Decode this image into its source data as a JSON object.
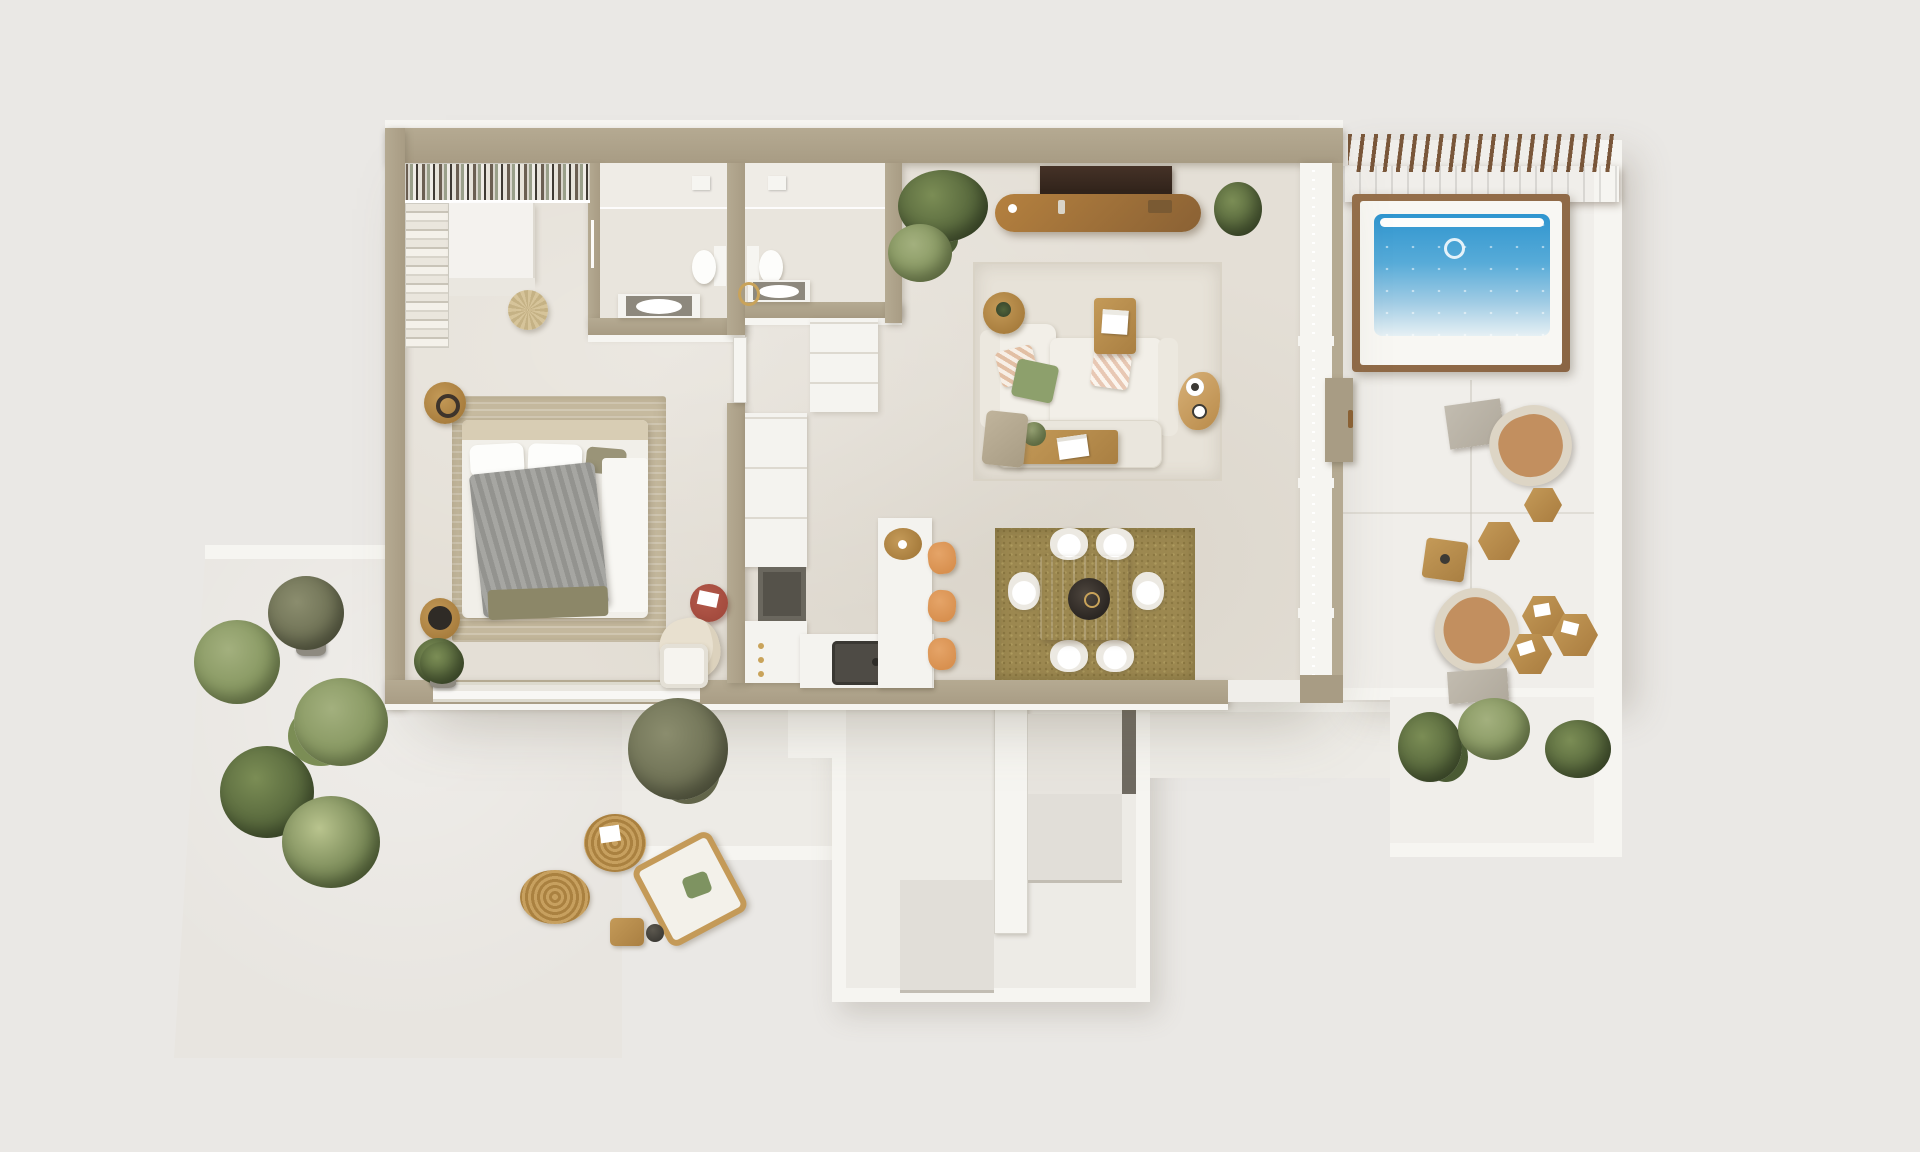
{
  "scene": {
    "view": "top-down 3D architectural floor plan render",
    "areas": [
      "walk-in-closet",
      "bedroom",
      "bathroom-1",
      "bathroom-2",
      "hallway",
      "kitchen",
      "dining-area",
      "living-room",
      "terrace-lounge",
      "pool-deck",
      "pergola",
      "patio-garden",
      "stairwell",
      "entry-landing"
    ]
  },
  "inventory": {
    "dining_chairs": 6,
    "bar_stools": 3,
    "sofas": 1,
    "beds": 1,
    "toilets": 2,
    "sinks": 3,
    "pools": 1,
    "lounge_chairs_terrace": 2,
    "lounge_chairs_patio": 2,
    "jute_rugs": 2,
    "plants": 14,
    "stair_flights": 2
  },
  "colors": {
    "bgPage": "#eae8e5",
    "wall": "#a89c84",
    "wallLight": "#b5aa92",
    "whiteW": "#f6f5f1",
    "floorIn": "#e4dfd6",
    "floorTerr": "#f0eeea",
    "floorPatio": "#e8e5e0",
    "floorEntry": "#edebe6",
    "wood": "#b5813f",
    "woodDark": "#8a6134",
    "woodMid": "#c49a58",
    "pergolaWood": "#8a6544",
    "pergolaSlat": "#7a573a",
    "poolA": "#2f95cf",
    "poolB": "#9fcbe4",
    "rugLiving": "#e7e2d8",
    "rugDining": "#9c8850",
    "rugBed": "#c6ba9f",
    "jute": "#c7a05f",
    "juteDark": "#aa8140",
    "sofa": "#f2efe8",
    "cushGreen": "#8da06c",
    "grayThrow": "#9b9b99",
    "stool": "#d8904f",
    "redTable": "#a34a3d",
    "leather": "#c28f5f",
    "frameCream": "#ddd5c5",
    "concrete": "#b0a99c",
    "plantL": "#7b8d55",
    "plantD": "#4a5a33",
    "oliveL": "#8b8d6e",
    "oliveD": "#62654a",
    "darkItem": "#3c3a35",
    "tread": "#e1ded8",
    "treadEdge": "#c2bdb3",
    "darkSlab": "#6f6a61",
    "gold": "#c9a35a",
    "tv": "#2e2119",
    "counterW": "#f4f3ef",
    "sinkDark": "#4e4b45",
    "tableWood": "#d2b582",
    "chairW": "#ece9e2",
    "oliveBand": "#8c8768",
    "cream": "#e8e0cf"
  }
}
